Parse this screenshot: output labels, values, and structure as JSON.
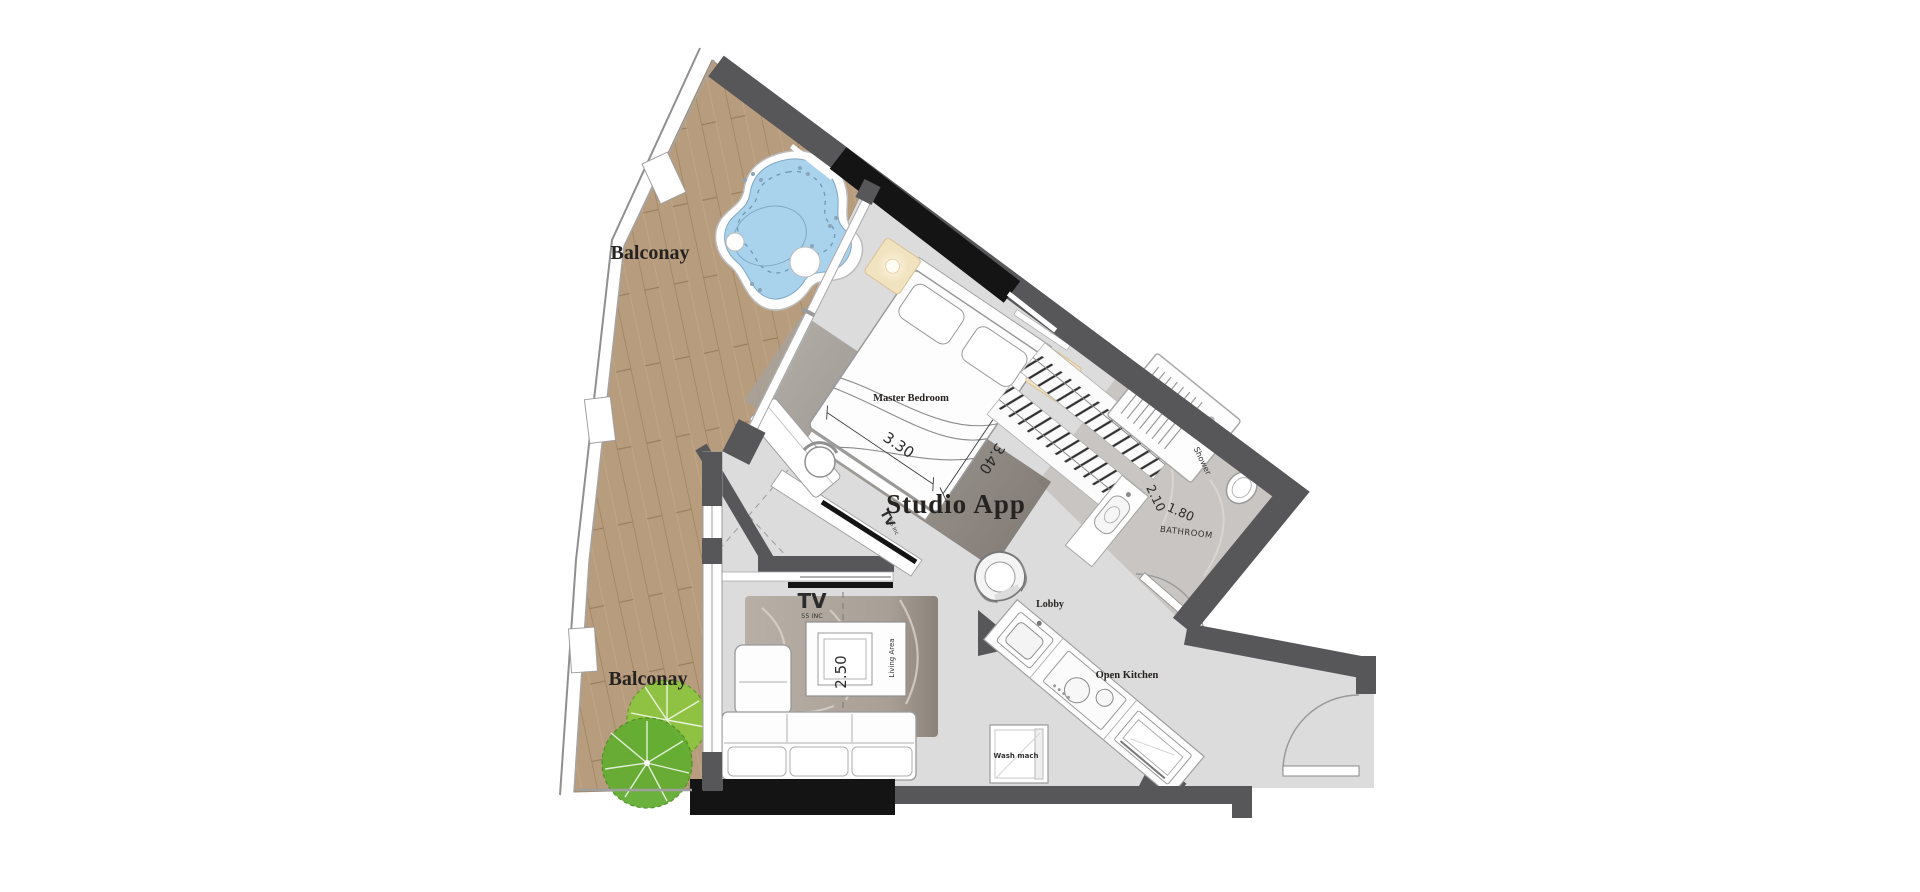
{
  "plan": {
    "unit_label": "Studio App",
    "rooms": {
      "balcony_top": "Balconay",
      "balcony_bottom": "Balconay",
      "master_bedroom": "Master Bedroom",
      "bathroom": "BATHROOM",
      "shower": "Shower",
      "lobby": "Lobby",
      "open_kitchen": "Open Kitchen",
      "living_area": "Living Area"
    },
    "dimensions": {
      "bedroom_width": "3.30",
      "bedroom_length": "3.40",
      "bathroom_length": "2.10",
      "bathroom_width": "1.80",
      "living_width": "2.50",
      "living_length": "3.20"
    },
    "appliances": {
      "living_tv_label": "TV",
      "living_tv_size": "55 INC",
      "bedroom_tv_label": "TV",
      "bedroom_tv_size": "55 inc",
      "washing_machine": "Wash mach"
    },
    "colors": {
      "wall": "#57575a",
      "wall_accent": "#141414",
      "balcony_wood": "#b79c7e",
      "interior_floor": "#dcdcdd",
      "bathroom_floor": "#c9c5c2",
      "pool_water": "#a9d2ec",
      "tree_foliage": "#6fb33a",
      "lamp_glow": "#f2e3c0"
    }
  }
}
